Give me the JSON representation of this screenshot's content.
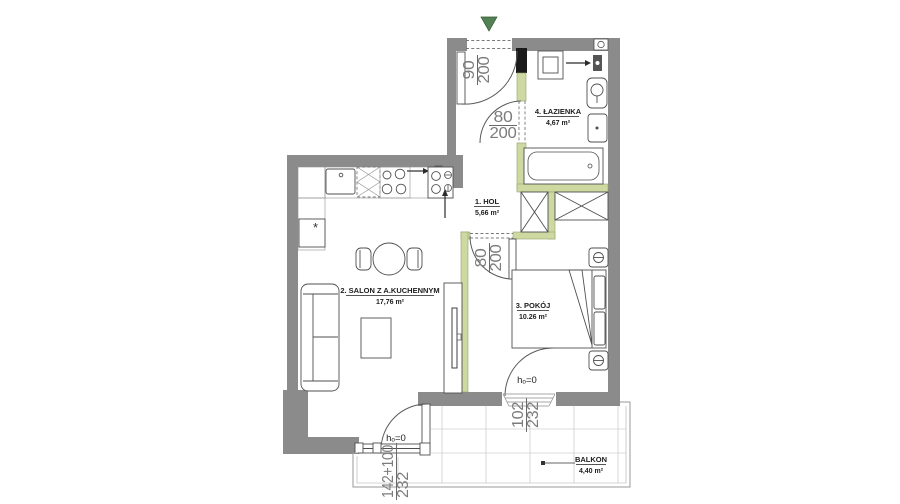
{
  "plan": {
    "rooms": {
      "hol": {
        "name": "1. HOL",
        "area": "5,66 m²"
      },
      "salon": {
        "name": "2. SALON Z A.KUCHENNYM",
        "area": "17,76 m²"
      },
      "pokoj": {
        "name": "3. POKÓJ",
        "area": "10.26 m²"
      },
      "lazienka": {
        "name": "4. ŁAZIENKA",
        "area": "4,67 m²"
      },
      "balkon": {
        "name": "BALKON",
        "area": "4,40 m²"
      }
    },
    "dimensions": {
      "entry_door": {
        "width": "90",
        "height": "200"
      },
      "bathroom_door": {
        "width": "80",
        "height": "200"
      },
      "pokoj_door": {
        "width": "80",
        "height": "200"
      },
      "pokoj_balcony_door": {
        "width": "102",
        "height": "232"
      },
      "salon_balcony_door": {
        "width": "142+100",
        "height": "232"
      }
    },
    "annotations": {
      "threshold_salon": "hₒ=0",
      "threshold_pokoj": "hₒ=0",
      "fridge_symbol": "*"
    },
    "colors": {
      "wall": "#8b8b8b",
      "partition_wall": "#cdd9a0",
      "entry_marker": "#538055",
      "dimension_text": "#7c7c7c",
      "line": "#4f4f4f"
    }
  }
}
